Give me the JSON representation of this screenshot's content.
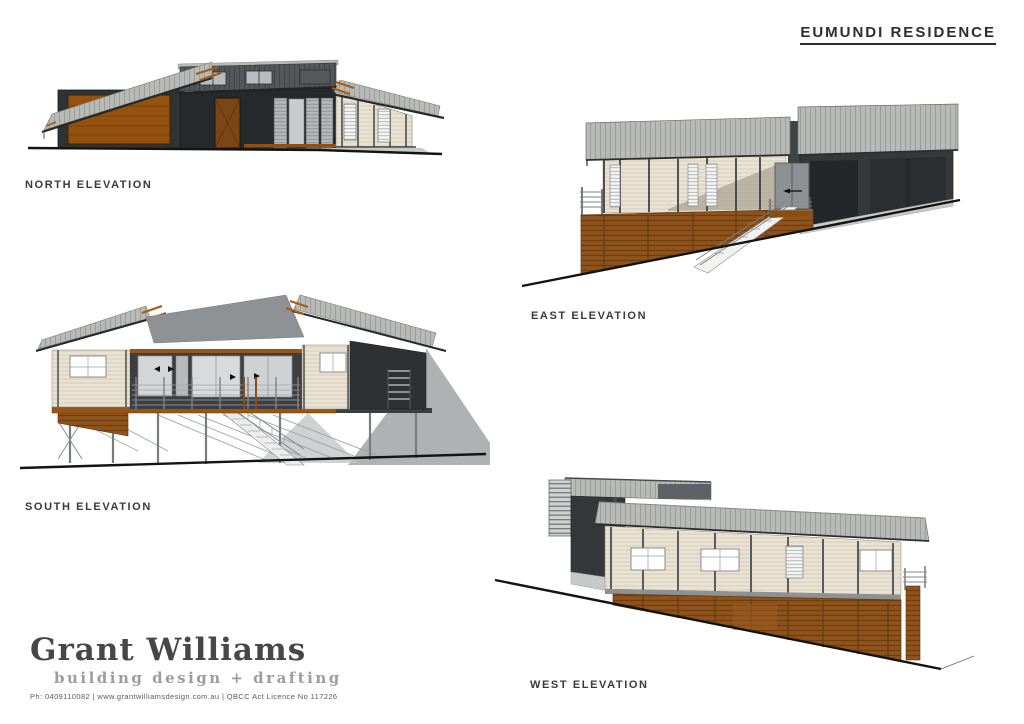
{
  "sheet": {
    "title": "EUMUNDI RESIDENCE"
  },
  "elevations": {
    "north": {
      "label": "NORTH ELEVATION"
    },
    "east": {
      "label": "EAST ELEVATION"
    },
    "south": {
      "label": "SOUTH ELEVATION"
    },
    "west": {
      "label": "WEST ELEVATION"
    }
  },
  "brand": {
    "name": "Grant Williams",
    "tagline": "building design + drafting",
    "contact": "Ph: 0409110082 | www.grantwilliamsdesign.com.au | QBCC Act Licence No 117226"
  },
  "colors": {
    "roof_grey": "#b8bab7",
    "clerestory_grey": "#53575a",
    "wall_charcoal": "#34383b",
    "cladding_cream": "#eae3d3",
    "timber_screen_brown": "#90531c",
    "garage_door_orange": "#95520f",
    "rafter_orange": "#a85c12",
    "ground_line": "#141414"
  }
}
